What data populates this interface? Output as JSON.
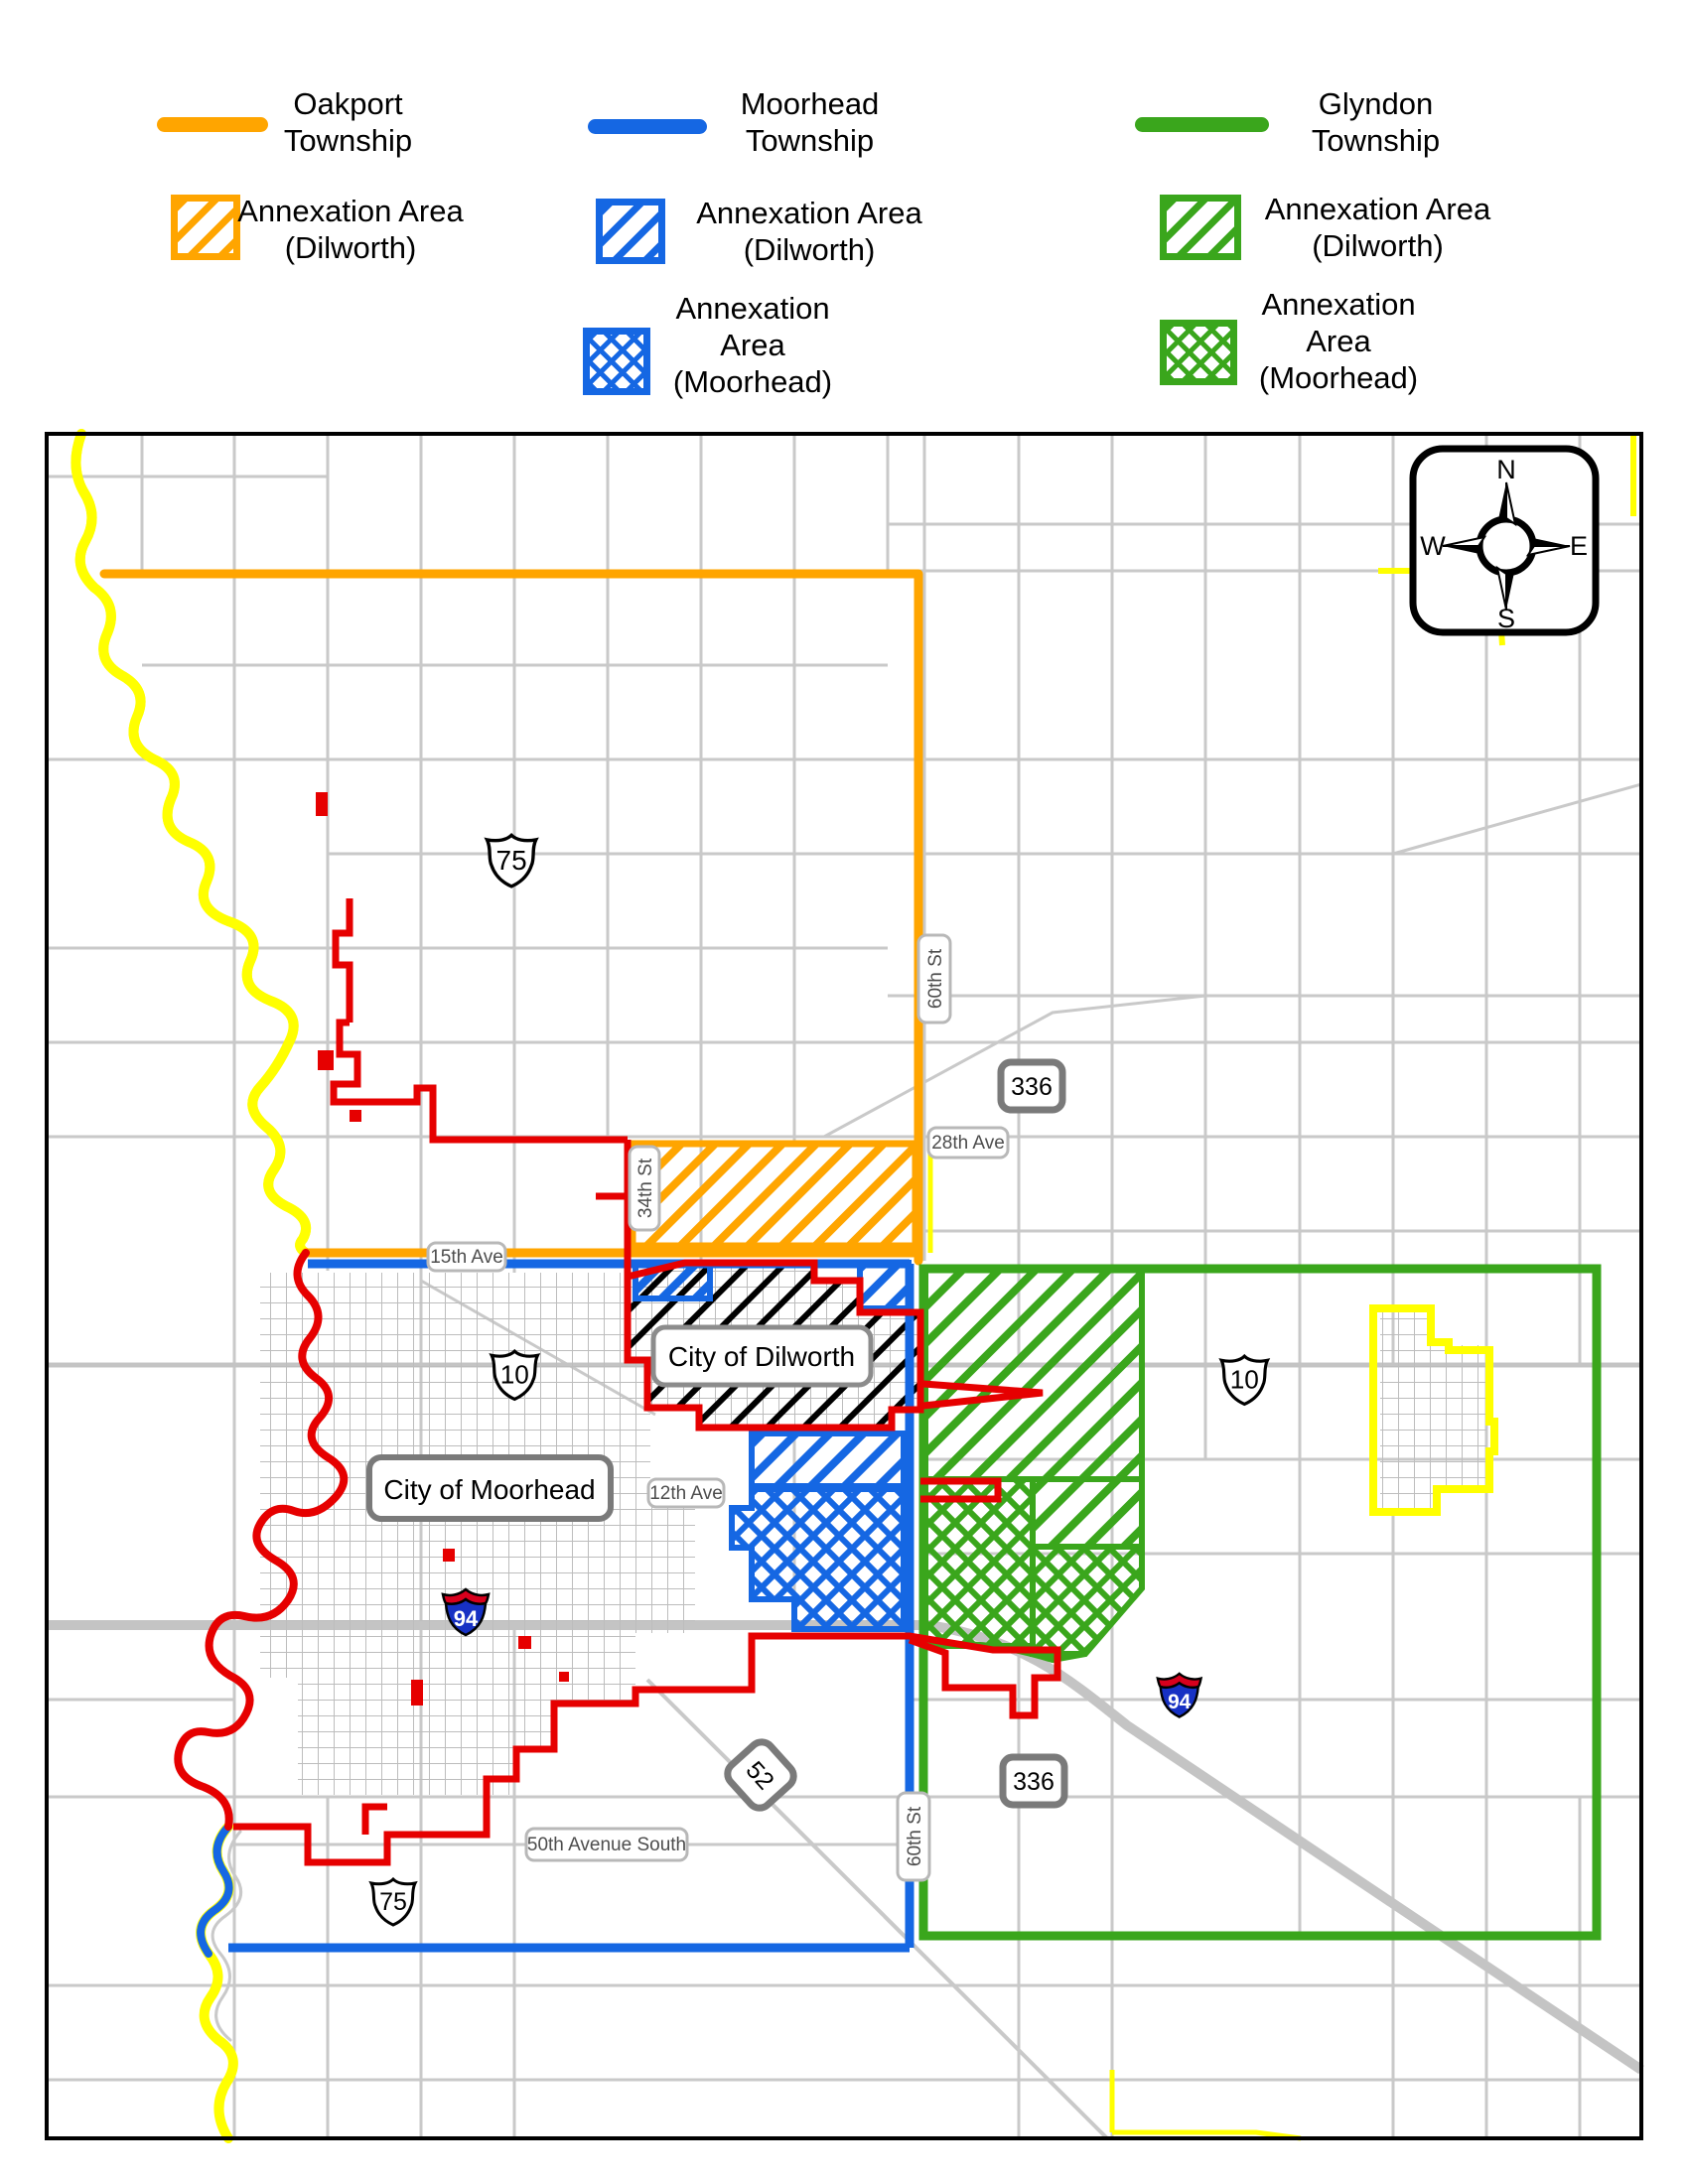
{
  "colors": {
    "oakport_orange": "#FFA500",
    "moorhead_blue": "#1567E3",
    "glyndon_green": "#3AA61C",
    "city_boundary_red": "#E60000",
    "river_yellow": "#FFFF00",
    "road_gray": "#C9C9C9"
  },
  "legend": {
    "columns": [
      {
        "township": "Oakport Township",
        "annexation_dilworth": "Annexation Area (Dilworth)"
      },
      {
        "township": "Moorhead Township",
        "annexation_dilworth": "Annexation Area (Dilworth)",
        "annexation_moorhead": "Annexation Area (Moorhead)"
      },
      {
        "township": "Glyndon Township",
        "annexation_dilworth": "Annexation Area (Dilworth)",
        "annexation_moorhead": "Annexation Area (Moorhead)"
      }
    ]
  },
  "map": {
    "cities": {
      "dilworth": "City of Dilworth",
      "moorhead": "City of Moorhead"
    },
    "streets": {
      "sixtieth_st_top": "60th St",
      "sixtieth_st_bottom": "60th St",
      "twentyeighth_ave": "28th Ave",
      "thirtyfourth_st": "34th St",
      "fifteenth_ave": "15th Ave",
      "twelfth_ave": "12th Ave",
      "fiftieth_ave_south": "50th Avenue South"
    },
    "shields": {
      "us75_top": "75",
      "us75_bottom": "75",
      "us10_left": "10",
      "us10_right": "10",
      "i94_left": "94",
      "i94_right": "94",
      "cr336_top": "336",
      "cr336_bottom": "336",
      "cr52": "52"
    },
    "compass": {
      "n": "N",
      "e": "E",
      "s": "S",
      "w": "W"
    }
  }
}
